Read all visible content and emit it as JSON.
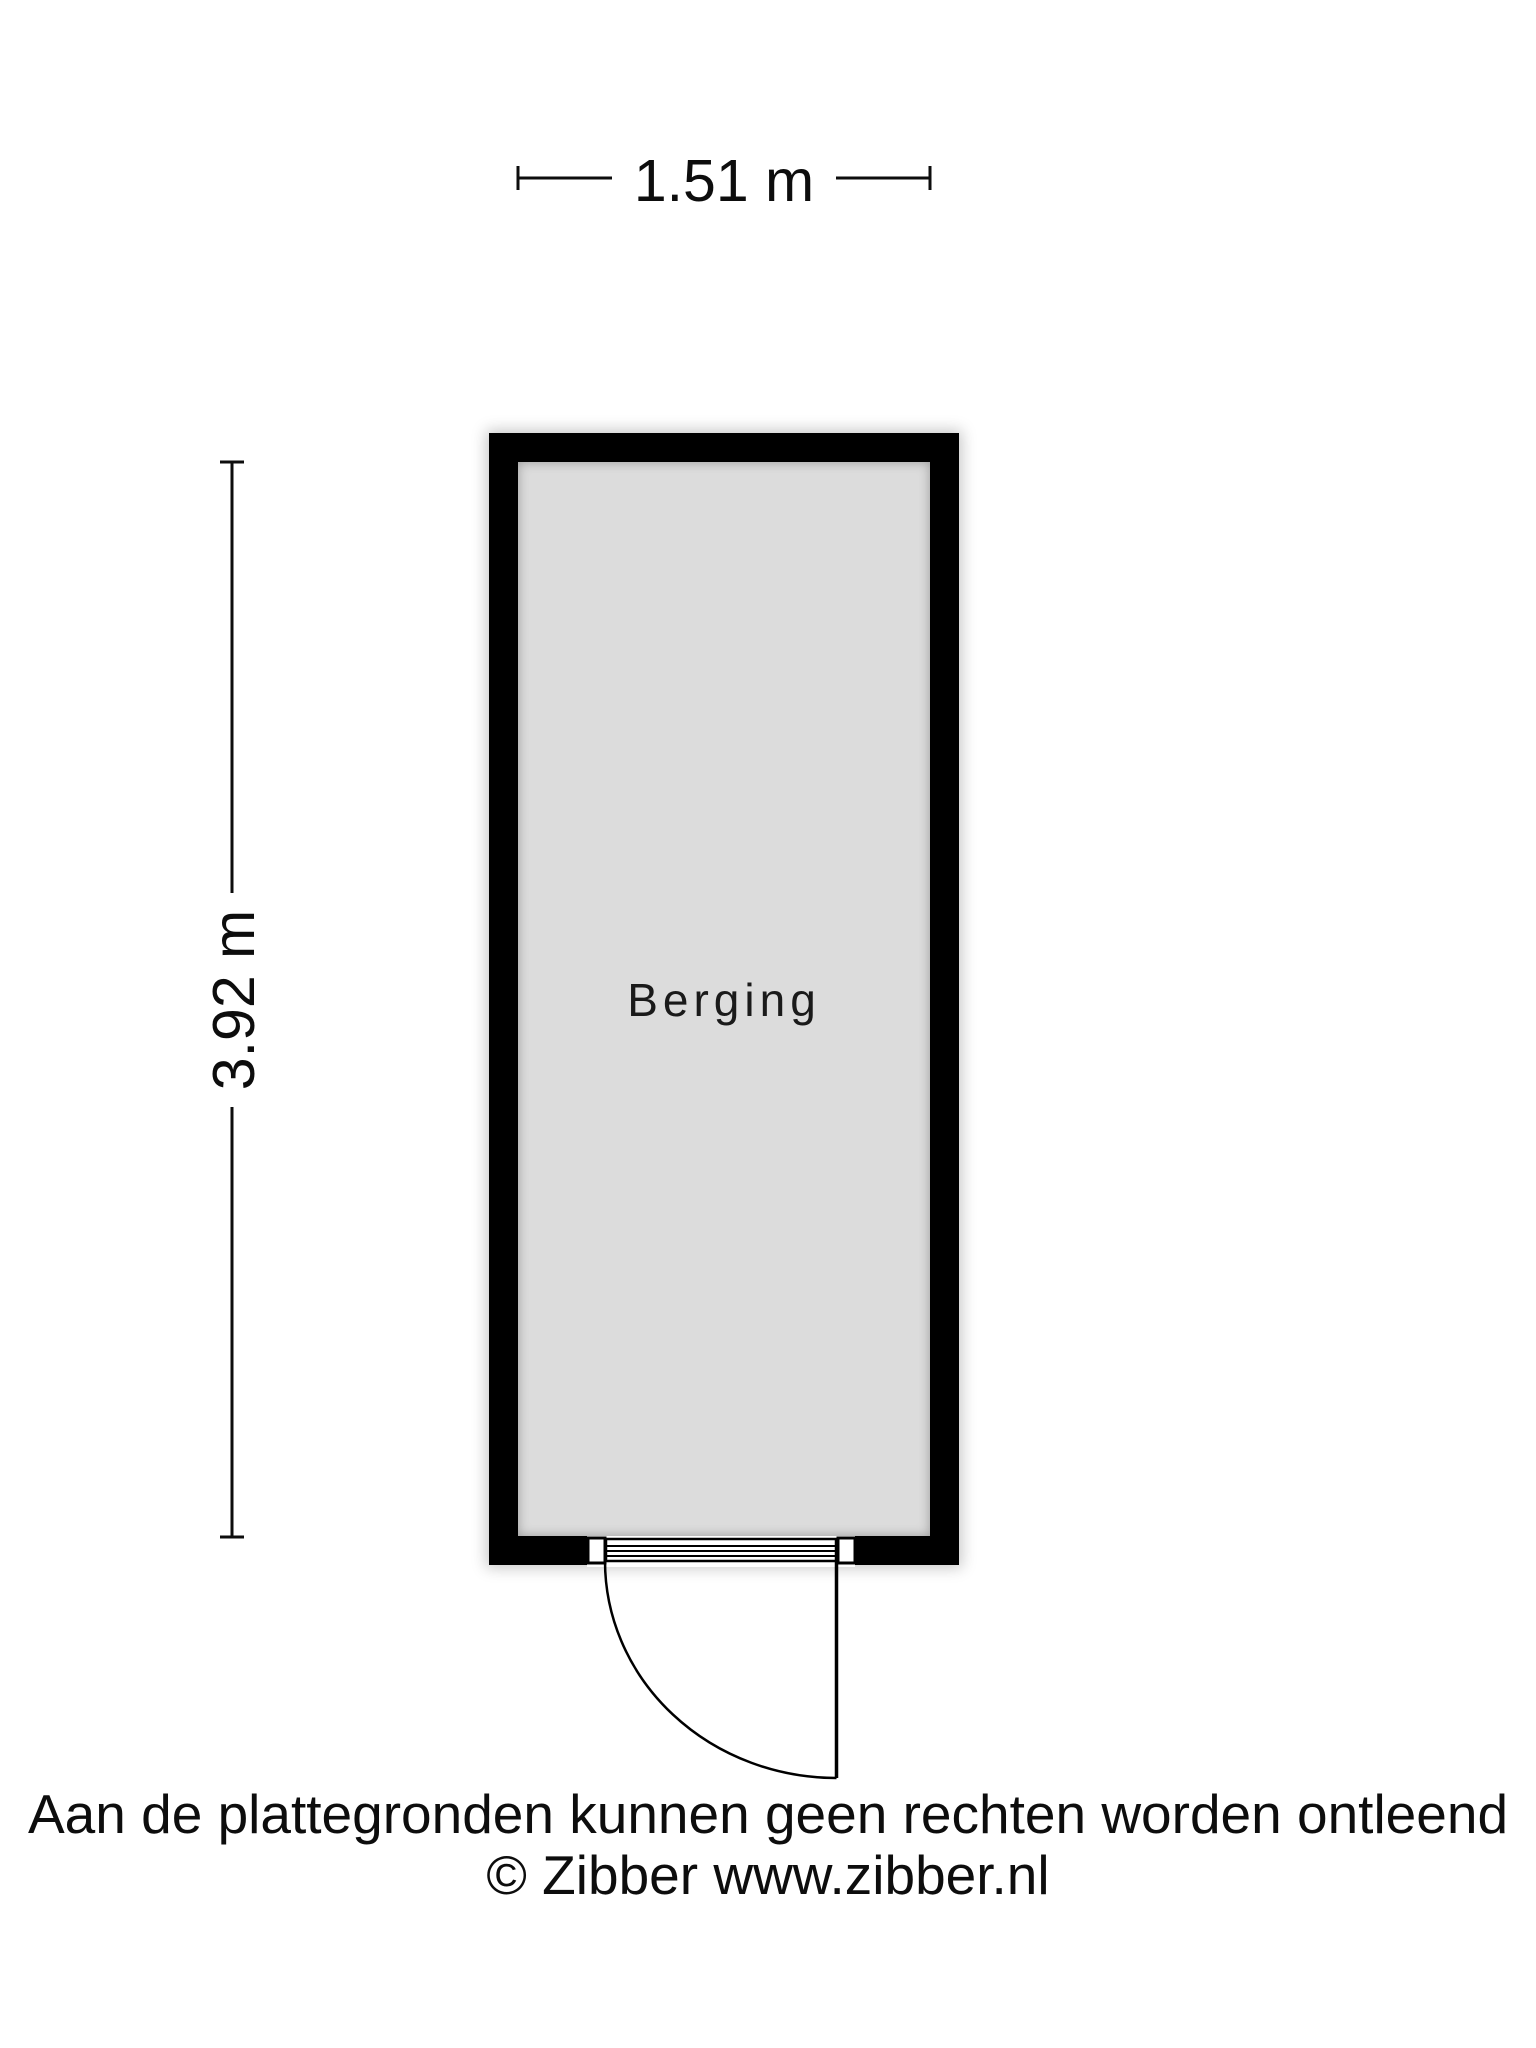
{
  "floorplan": {
    "room_label": "Berging",
    "width_dimension": "1.51 m",
    "height_dimension": "3.92 m",
    "disclaimer_line1": "Aan de plattegronden kunnen geen rechten worden ontleend",
    "disclaimer_line2": "© Zibber www.zibber.nl",
    "colors": {
      "wall": "#000000",
      "floor": "#dcdcdc",
      "line": "#000000",
      "background": "#ffffff"
    }
  }
}
